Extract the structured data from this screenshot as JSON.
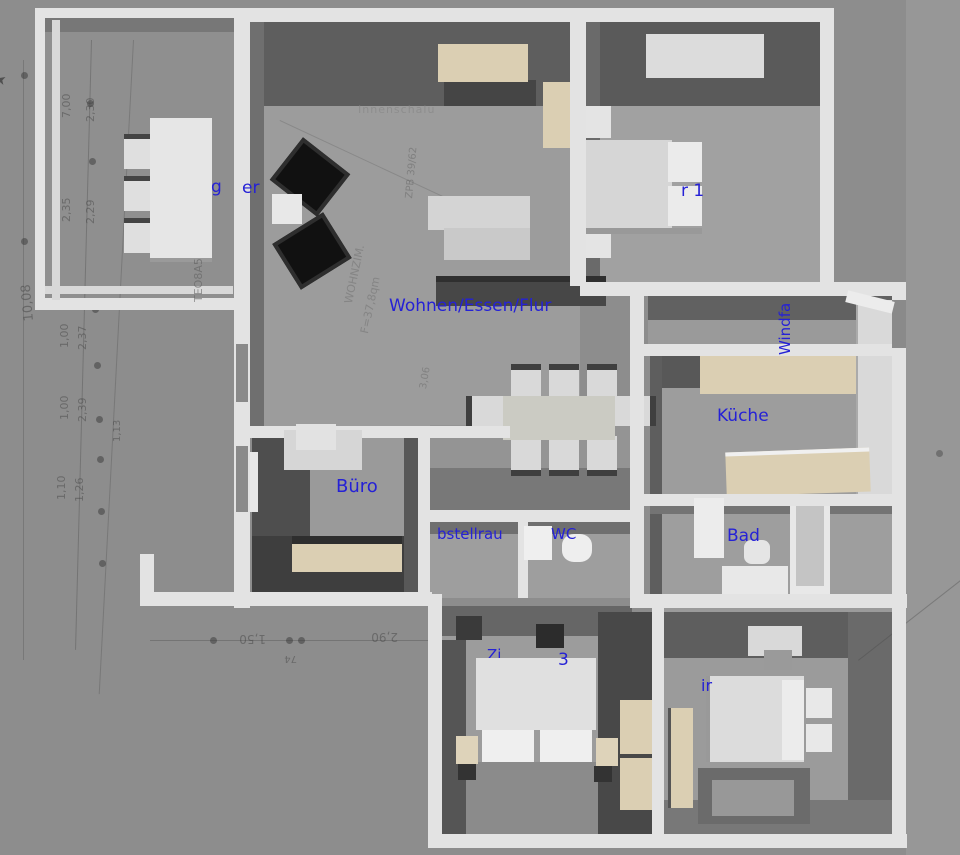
{
  "room_labels": {
    "living": "Wohnen/Essen/Flur",
    "kitchen": "Küche",
    "bathroom": "Bad",
    "office": "Büro",
    "wc": "WC",
    "storage_fragment": "bstellrau",
    "bedroom1_fragment": "r 1",
    "bedroom3_fragment_a": "Zi",
    "bedroom3_fragment_b": "3",
    "bedroom2_fragment": "ir",
    "vestibule_fragment": "Windfa",
    "conservatory_fragment_a": "k",
    "conservatory_fragment_b": "g",
    "conservatory_fragment_c": "er"
  },
  "plan_annotations": {
    "header_note": "Innenschalu",
    "overall_dim": "10,08",
    "dim_a": "7,00",
    "dim_b": "2,30",
    "dim_c": "2,35",
    "dim_d": "2,29",
    "dim_e": "1,00",
    "dim_f": "2,37",
    "dim_g": "1,00",
    "dim_h": "2,39",
    "dim_i": "1,13",
    "dim_j": "1,10",
    "dim_k": "1,26",
    "dim_l": "1,50",
    "dim_m": "74",
    "dim_n": "2,90",
    "pencil_wall": "TEO8A5",
    "pencil_room": "WOHNZIM.",
    "pencil_area": "F=37,8qm",
    "pencil_ref": "ZPB 39/62",
    "pencil_dim": "3,06",
    "pencil_dim2": "2,0",
    "arrow_glyph": "➤"
  },
  "colors": {
    "label_blue": "#2521d6",
    "wall_white": "#e3e3e3",
    "wall_face_dark": "#5a5a5a",
    "floor_gray": "#9b9b9b",
    "furniture_beige": "#dbcfb3",
    "background": "#8d8d8d"
  }
}
